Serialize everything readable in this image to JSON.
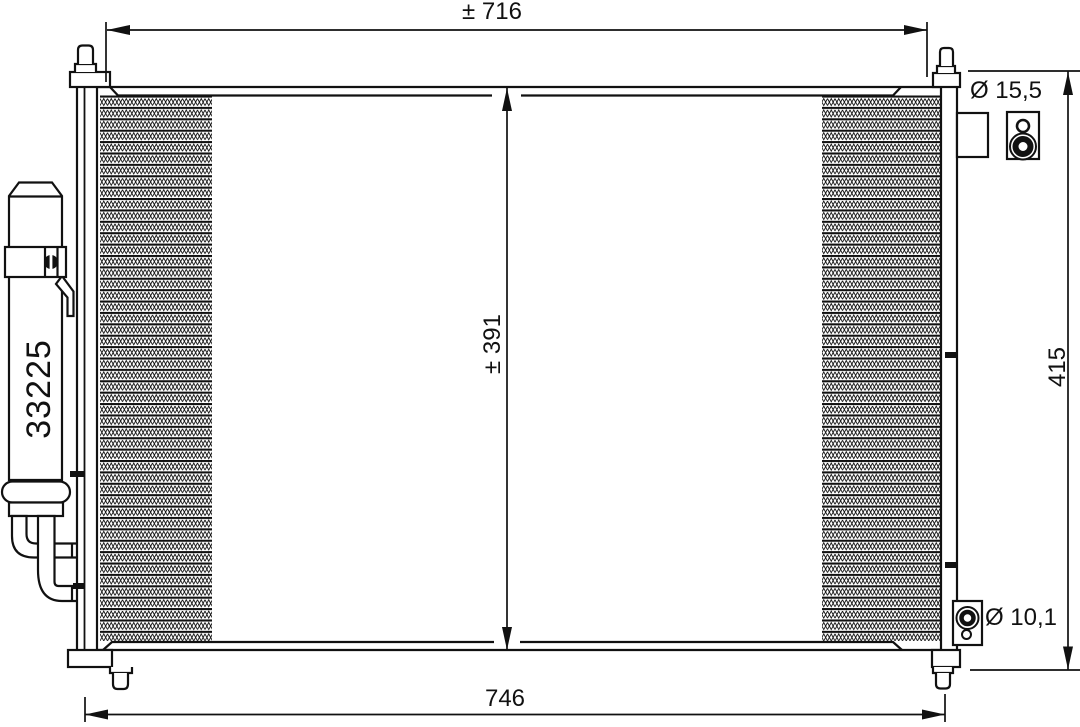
{
  "drawing": {
    "kind": "automotive-condenser-technical-drawing",
    "part_number": "33225",
    "dimensions": {
      "top_width": "± 716",
      "core_height": "± 391",
      "overall_height": "415",
      "bottom_width": "746",
      "top_port_diameter": "Ø 15,5",
      "bottom_port_diameter": "Ø 10,1"
    },
    "colors": {
      "line": "#111111",
      "background": "#ffffff"
    }
  }
}
